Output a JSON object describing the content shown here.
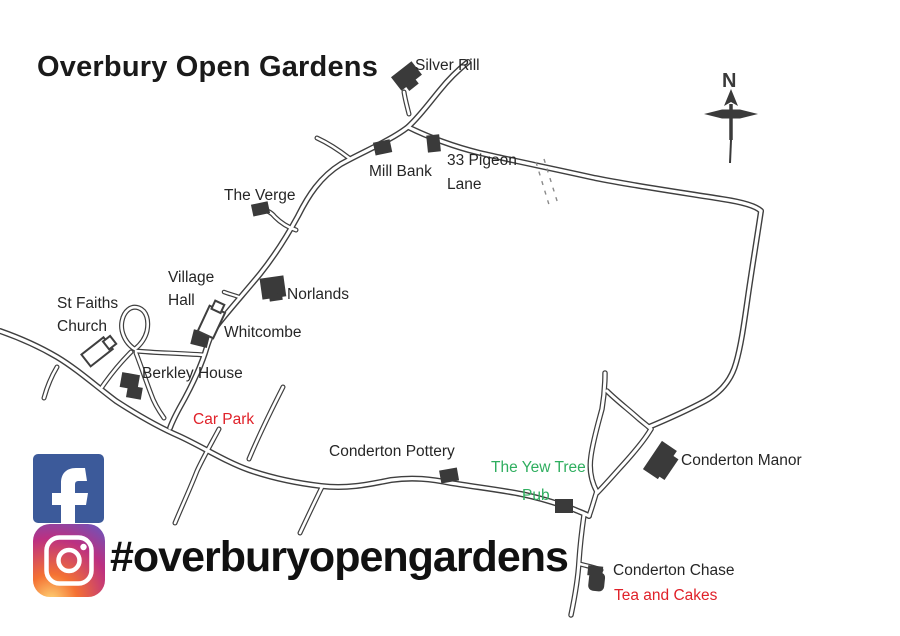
{
  "header": {
    "title": "Overbury Open Gardens"
  },
  "footer": {
    "hashtag": "#overburyopengardens"
  },
  "compass": {
    "label": "N"
  },
  "icons": {
    "facebook": "facebook-f-icon",
    "instagram": "instagram-camera-icon",
    "compass": "north-compass-icon"
  },
  "colors": {
    "ink": "#3f3f3f",
    "label_red": "#e02129",
    "label_green": "#2fae5f",
    "facebook_blue": "#3c5a9a",
    "instagram_gradient": [
      "#fed576",
      "#f47133",
      "#bc3081",
      "#4c63d2"
    ]
  },
  "map": {
    "labels": {
      "silver_rill": "Silver Rill",
      "mill_bank": "Mill Bank",
      "pigeon_line1": "33 Pigeon",
      "pigeon_line2": "Lane",
      "the_verge": "The Verge",
      "village_hall_line1": "Village",
      "village_hall_line2": "Hall",
      "st_faiths_line1": "St Faiths",
      "st_faiths_line2": "Church",
      "norlands": "Norlands",
      "whitcombe": "Whitcombe",
      "berkley_house": "Berkley House",
      "car_park": "Car Park",
      "conderton_pottery": "Conderton Pottery",
      "yew_tree_line1": "The Yew Tree",
      "yew_tree_line2": "Pub",
      "conderton_manor": "Conderton Manor",
      "conderton_chase": "Conderton Chase",
      "tea_and_cakes": "Tea and Cakes"
    }
  }
}
